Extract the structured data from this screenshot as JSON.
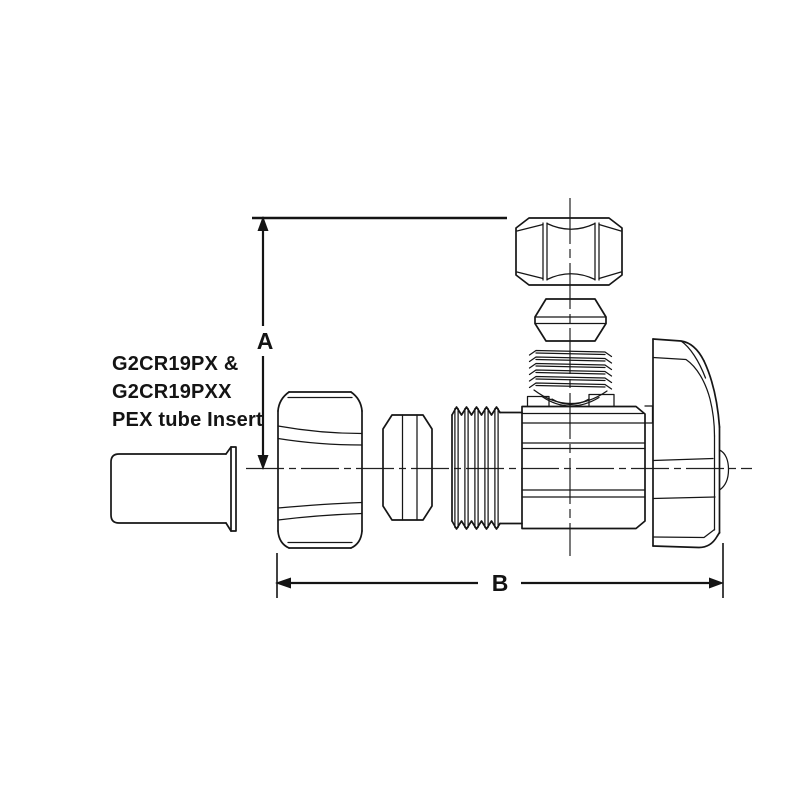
{
  "canvas": {
    "background_color": "#ffffff",
    "line_color": "#161616"
  },
  "annotation": {
    "line1": "G2CR19PX &",
    "line2": "G2CR19PXX",
    "line3": "PEX tube Insert"
  },
  "dimensions": {
    "vertical_label": "A",
    "horizontal_label": "B"
  }
}
